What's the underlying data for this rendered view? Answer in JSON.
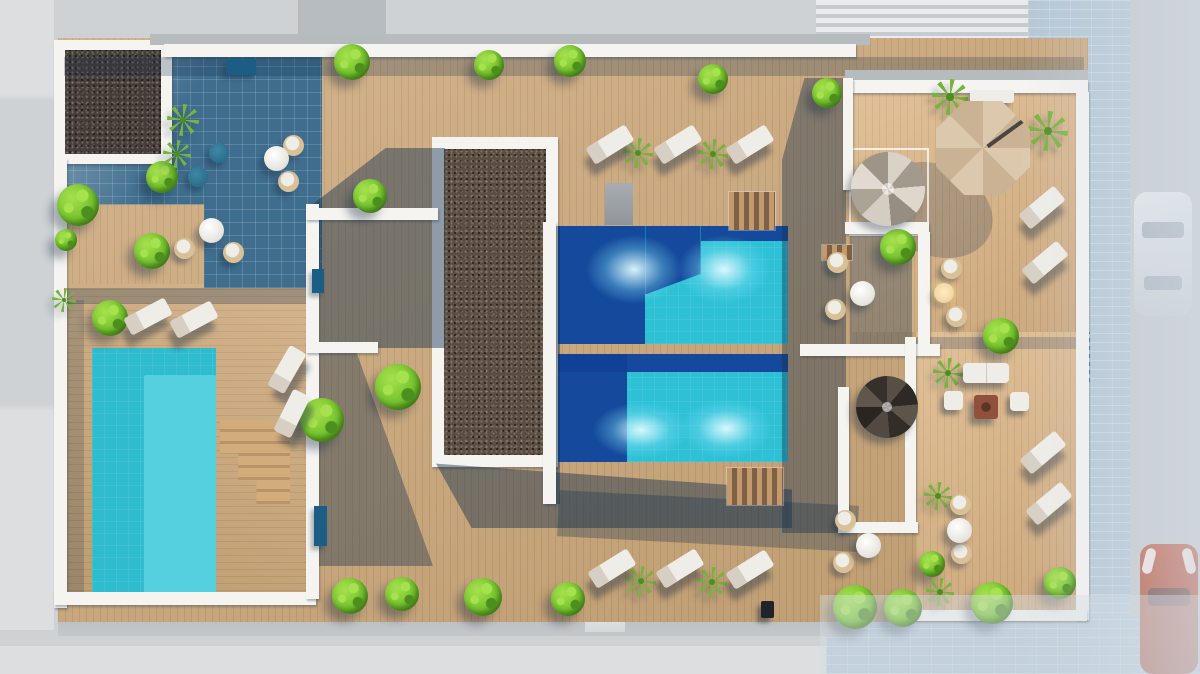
{
  "scene": {
    "description": "Aerial 3D architectural render of a rooftop terrace: two central stepped pools, a private side pool, gravel roof planters, timber decks, lounge furniture, parasol, spiral stairs, street with two cars at right"
  },
  "palette": {
    "bg": "#ced2d5",
    "bgLight": "#dcdedf",
    "bandDark": "#b7bcc1",
    "stripeA": "#e9ebec",
    "stripeB": "#c6cbcf",
    "pavement": "#b5c7d6",
    "road": "#c5cacd",
    "ledge": "#b3b8bc",
    "wood": "#cda87a",
    "woodWarm": "#d7b083",
    "tile": "#3f6d8e",
    "gravelDark": "#453d38",
    "gravelBrown": "#5a4c41",
    "wall": "#f5f4f1",
    "parapet": "#b6bbbe",
    "poolTurq": "#2ec1d6",
    "poolDeep": "#123f97",
    "leftPool": "#2fbccf",
    "leftPoolLight": "#5cd3e1",
    "bush": "#76c42e",
    "bushLight": "#a6e14e",
    "bushDark": "#4d8f1d",
    "palm": "#76b43a",
    "wicker": "#d9c197",
    "furniture": "#efede8",
    "loungerShade": "#d7cfc3",
    "umbrella": "#dcc9ad",
    "umbrellaDark": "#c9b394",
    "pouf": "#2a6d8c",
    "planter": "#1c5d85",
    "fire": "#91503c",
    "tableLit": "#f2d9a8",
    "speaker": "#20242a",
    "carRed": "#c0563e",
    "carWhite": "#dfe3e6",
    "orange": "#c08552"
  },
  "items": [
    {
      "type": "bush",
      "x": 352,
      "y": 62,
      "w": 36,
      "h": 36
    },
    {
      "type": "bush",
      "x": 489,
      "y": 65,
      "w": 30,
      "h": 30
    },
    {
      "type": "bush",
      "x": 570,
      "y": 61,
      "w": 32,
      "h": 32
    },
    {
      "type": "bush",
      "x": 713,
      "y": 79,
      "w": 30,
      "h": 30
    },
    {
      "type": "bush",
      "x": 827,
      "y": 93,
      "w": 30,
      "h": 30
    },
    {
      "type": "bush",
      "x": 78,
      "y": 205,
      "w": 42,
      "h": 42
    },
    {
      "type": "bush",
      "x": 110,
      "y": 318,
      "w": 36,
      "h": 36
    },
    {
      "type": "bush",
      "x": 162,
      "y": 177,
      "w": 32,
      "h": 32
    },
    {
      "type": "bush",
      "x": 152,
      "y": 251,
      "w": 36,
      "h": 36
    },
    {
      "type": "bush",
      "x": 66,
      "y": 240,
      "w": 22,
      "h": 22
    },
    {
      "type": "bush",
      "x": 370,
      "y": 196,
      "w": 34,
      "h": 34
    },
    {
      "type": "bush",
      "x": 398,
      "y": 387,
      "w": 46,
      "h": 46
    },
    {
      "type": "bush",
      "x": 322,
      "y": 420,
      "w": 44,
      "h": 44
    },
    {
      "type": "bush",
      "x": 350,
      "y": 596,
      "w": 36,
      "h": 36
    },
    {
      "type": "bush",
      "x": 402,
      "y": 594,
      "w": 34,
      "h": 34
    },
    {
      "type": "bush",
      "x": 483,
      "y": 597,
      "w": 38,
      "h": 38
    },
    {
      "type": "bush",
      "x": 568,
      "y": 599,
      "w": 34,
      "h": 34
    },
    {
      "type": "bush",
      "x": 855,
      "y": 607,
      "w": 44,
      "h": 44
    },
    {
      "type": "bush",
      "x": 903,
      "y": 608,
      "w": 38,
      "h": 38
    },
    {
      "type": "bush",
      "x": 992,
      "y": 603,
      "w": 42,
      "h": 42
    },
    {
      "type": "bush",
      "x": 1060,
      "y": 583,
      "w": 32,
      "h": 32
    },
    {
      "type": "bush",
      "x": 898,
      "y": 247,
      "w": 36,
      "h": 36
    },
    {
      "type": "bush",
      "x": 1001,
      "y": 336,
      "w": 36,
      "h": 36
    },
    {
      "type": "bush",
      "x": 932,
      "y": 564,
      "w": 26,
      "h": 26
    },
    {
      "type": "palm",
      "x": 950,
      "y": 97,
      "w": 36,
      "h": 36
    },
    {
      "type": "palm",
      "x": 1048,
      "y": 131,
      "w": 40,
      "h": 40
    },
    {
      "type": "palm",
      "x": 183,
      "y": 120,
      "w": 32,
      "h": 32
    },
    {
      "type": "palm",
      "x": 177,
      "y": 154,
      "w": 28,
      "h": 28
    },
    {
      "type": "palm",
      "x": 638,
      "y": 153,
      "w": 30,
      "h": 30
    },
    {
      "type": "palm",
      "x": 713,
      "y": 154,
      "w": 30,
      "h": 30
    },
    {
      "type": "palm",
      "x": 641,
      "y": 581,
      "w": 30,
      "h": 30
    },
    {
      "type": "palm",
      "x": 712,
      "y": 582,
      "w": 30,
      "h": 30
    },
    {
      "type": "palm",
      "x": 948,
      "y": 373,
      "w": 30,
      "h": 30
    },
    {
      "type": "palm",
      "x": 940,
      "y": 592,
      "w": 28,
      "h": 28
    },
    {
      "type": "palm",
      "x": 938,
      "y": 496,
      "w": 28,
      "h": 28
    },
    {
      "type": "palm",
      "x": 64,
      "y": 300,
      "w": 24,
      "h": 24
    },
    {
      "type": "lounger",
      "x": 148,
      "y": 316,
      "w": 46,
      "h": 19,
      "rot": -28
    },
    {
      "type": "lounger",
      "x": 194,
      "y": 319,
      "w": 46,
      "h": 19,
      "rot": -28
    },
    {
      "type": "lounger",
      "x": 287,
      "y": 369,
      "w": 46,
      "h": 19,
      "rot": -60
    },
    {
      "type": "lounger",
      "x": 292,
      "y": 413,
      "w": 46,
      "h": 19,
      "rot": -64
    },
    {
      "type": "lounger",
      "x": 610,
      "y": 144,
      "w": 46,
      "h": 19,
      "rot": -32
    },
    {
      "type": "lounger",
      "x": 678,
      "y": 144,
      "w": 46,
      "h": 19,
      "rot": -32
    },
    {
      "type": "lounger",
      "x": 750,
      "y": 144,
      "w": 46,
      "h": 19,
      "rot": -32
    },
    {
      "type": "lounger",
      "x": 612,
      "y": 568,
      "w": 46,
      "h": 19,
      "rot": -32
    },
    {
      "type": "lounger",
      "x": 680,
      "y": 568,
      "w": 46,
      "h": 19,
      "rot": -32
    },
    {
      "type": "lounger",
      "x": 750,
      "y": 569,
      "w": 46,
      "h": 19,
      "rot": -32
    },
    {
      "type": "lounger",
      "x": 1042,
      "y": 207,
      "w": 46,
      "h": 19,
      "rot": -40
    },
    {
      "type": "lounger",
      "x": 1045,
      "y": 262,
      "w": 46,
      "h": 19,
      "rot": -40
    },
    {
      "type": "lounger",
      "x": 1043,
      "y": 452,
      "w": 46,
      "h": 19,
      "rot": -40
    },
    {
      "type": "lounger",
      "x": 1049,
      "y": 503,
      "w": 46,
      "h": 19,
      "rot": -40
    },
    {
      "type": "wicker-chair",
      "x": 293,
      "y": 145,
      "w": 21,
      "h": 21
    },
    {
      "type": "wicker-chair",
      "x": 288,
      "y": 181,
      "w": 21,
      "h": 21
    },
    {
      "type": "wicker-chair",
      "x": 184,
      "y": 248,
      "w": 21,
      "h": 21
    },
    {
      "type": "wicker-chair",
      "x": 233,
      "y": 252,
      "w": 21,
      "h": 21
    },
    {
      "type": "wicker-chair",
      "x": 837,
      "y": 262,
      "w": 21,
      "h": 21
    },
    {
      "type": "wicker-chair",
      "x": 835,
      "y": 309,
      "w": 21,
      "h": 21
    },
    {
      "type": "wicker-chair",
      "x": 951,
      "y": 268,
      "w": 21,
      "h": 21
    },
    {
      "type": "wicker-chair",
      "x": 956,
      "y": 316,
      "w": 21,
      "h": 21
    },
    {
      "type": "wicker-chair",
      "x": 845,
      "y": 520,
      "w": 21,
      "h": 21
    },
    {
      "type": "wicker-chair",
      "x": 843,
      "y": 562,
      "w": 21,
      "h": 21
    },
    {
      "type": "wicker-chair",
      "x": 960,
      "y": 504,
      "w": 21,
      "h": 21
    },
    {
      "type": "wicker-chair",
      "x": 961,
      "y": 553,
      "w": 21,
      "h": 21
    },
    {
      "type": "round-table",
      "x": 276,
      "y": 158,
      "w": 25,
      "h": 25
    },
    {
      "type": "round-table",
      "x": 211,
      "y": 230,
      "w": 25,
      "h": 25
    },
    {
      "type": "round-table",
      "x": 862,
      "y": 293,
      "w": 25,
      "h": 25
    },
    {
      "type": "round-table",
      "x": 868,
      "y": 545,
      "w": 25,
      "h": 25
    },
    {
      "type": "round-table",
      "x": 959,
      "y": 530,
      "w": 25,
      "h": 25
    },
    {
      "type": "lit-table",
      "x": 944,
      "y": 293,
      "w": 20,
      "h": 20
    },
    {
      "type": "pouf",
      "x": 219,
      "y": 153,
      "w": 20,
      "h": 20
    },
    {
      "type": "pouf",
      "x": 198,
      "y": 177,
      "w": 20,
      "h": 20
    },
    {
      "type": "planter",
      "x": 241,
      "y": 67,
      "w": 30,
      "h": 16
    },
    {
      "type": "planter",
      "x": 318,
      "y": 281,
      "w": 12,
      "h": 24
    },
    {
      "type": "planter",
      "x": 320,
      "y": 526,
      "w": 13,
      "h": 40
    },
    {
      "type": "bench",
      "x": 992,
      "y": 96,
      "w": 44,
      "h": 13
    },
    {
      "type": "sofa",
      "x": 986,
      "y": 373,
      "w": 46,
      "h": 20
    },
    {
      "type": "armchair",
      "x": 953,
      "y": 400,
      "w": 19,
      "h": 19
    },
    {
      "type": "armchair",
      "x": 1019,
      "y": 401,
      "w": 19,
      "h": 19
    },
    {
      "type": "fire-table",
      "x": 986,
      "y": 407,
      "w": 24,
      "h": 24
    },
    {
      "type": "speaker",
      "x": 767,
      "y": 609,
      "w": 13,
      "h": 17
    },
    {
      "type": "spiral-light",
      "x": 888,
      "y": 189,
      "w": 74,
      "h": 74
    },
    {
      "type": "spiral-dark",
      "x": 887,
      "y": 407,
      "w": 62,
      "h": 62
    },
    {
      "type": "umbrella",
      "x": 983,
      "y": 148,
      "w": 94,
      "h": 94
    }
  ]
}
